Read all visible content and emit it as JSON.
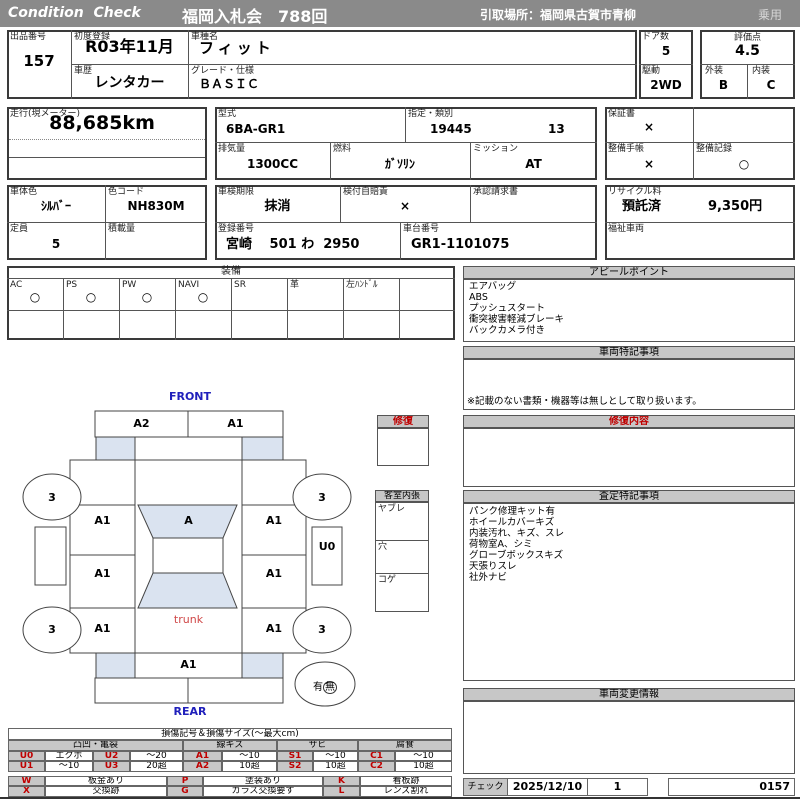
{
  "header": {
    "brand": "Condition  Check",
    "title": "福岡入札会　788回",
    "pickup": "引取場所：福岡県古賀市青柳",
    "usage": "乗用"
  },
  "info": {
    "lot_label": "出品番号",
    "lot": "157",
    "first_reg_label": "初度登録",
    "first_reg": "R03年11月",
    "model_label": "車種名",
    "model": "フィット",
    "history_label": "車歴",
    "history": "レンタカー",
    "grade_label": "グレード・仕様",
    "grade": "ＢＡＳＩＣ",
    "doors_label": "ドア数",
    "doors": "5",
    "drive_label": "駆動",
    "drive": "2WD",
    "score_label": "評価点",
    "score": "4.5",
    "ext_label": "外装",
    "ext": "B",
    "int_label": "内装",
    "int": "C",
    "mileage_label": "走行(現メーター)",
    "mileage": "88,685km",
    "type_label": "型式",
    "type": "6BA-GR1",
    "desig_label": "指定・類別",
    "desig1": "19445",
    "desig2": "13",
    "disp_label": "排気量",
    "disp": "1300CC",
    "fuel_label": "燃料",
    "fuel": "ｶﾞｿﾘﾝ",
    "trans_label": "ミッション",
    "trans": "AT",
    "warranty_label": "保証書",
    "warranty": "×",
    "maint_book_label": "整備手帳",
    "maint_book": "×",
    "maint_rec_label": "整備記録",
    "maint_rec": "○",
    "color_label": "車体色",
    "color": "ｼﾙﾊﾞｰ",
    "color_code_label": "色コード",
    "color_code": "NH830M",
    "capacity_label": "定員",
    "capacity": "5",
    "load_label": "積載量",
    "load": "",
    "inspection_label": "車検期限",
    "inspection": "抹消",
    "insurance_label": "検付自賠責",
    "insurance": "×",
    "approval_label": "承認請求書",
    "approval": "",
    "reg_no_label": "登録番号",
    "reg_no": "宮崎　 501 わ  2950",
    "chassis_label": "車台番号",
    "chassis": "GR1-1101075",
    "recycle_label": "リサイクル料",
    "recycle_status": "預託済",
    "recycle_fee": "9,350円",
    "welfare_label": "福祉車両",
    "welfare": ""
  },
  "equipment": {
    "title": "装備",
    "labels": [
      "AC",
      "PS",
      "PW",
      "NAVI",
      "SR",
      "革",
      "左ﾊﾝﾄﾞﾙ",
      ""
    ],
    "marks": [
      "○",
      "○",
      "○",
      "○",
      "",
      "",
      "",
      ""
    ]
  },
  "appeal": {
    "title": "アピールポイント",
    "lines": [
      "エアバッグ",
      "ABS",
      "プッシュスタート",
      "衝突被害軽減ブレーキ",
      "バックカメラ付き"
    ]
  },
  "vehicle_notes": {
    "title": "車両特記事項",
    "note": "※記載のない書類・機器等は無しとして取り扱います。"
  },
  "repair_section": {
    "title": "修復内容"
  },
  "repair_panel": {
    "title": "修復"
  },
  "cabin": {
    "title": "客室内張",
    "rows": [
      "ヤブレ",
      "穴",
      "コゲ"
    ]
  },
  "assessment": {
    "title": "査定特記事項",
    "lines": [
      "パンク修理キット有",
      "ホイールカバーキズ",
      "内装汚れ、キズ、スレ",
      "荷物室A、シミ",
      "グローブボックスキズ",
      "天張りスレ",
      "社外ナビ"
    ]
  },
  "change_info": {
    "title": "車両変更情報"
  },
  "check": {
    "label": "チェック",
    "date": "2025/12/10",
    "count": "1",
    "number": "0157"
  },
  "diagram": {
    "front": "FRONT",
    "rear": "REAR",
    "bumper_left": "A2",
    "bumper_right": "A1",
    "wheel": "3",
    "left_front_panel": "A1",
    "windshield": "A",
    "right_front_panel": "A1",
    "right_strip": "U0",
    "left_door": "A1",
    "right_door": "A1",
    "left_quarter": "A1",
    "trunk": "trunk",
    "right_quarter": "A1",
    "rear_panel": "A1",
    "spare_has": "有",
    "spare_none": "無"
  },
  "legend": {
    "title": "損傷記号＆損傷サイズ(〜最大cm)",
    "groups": [
      "凸凹・亀裂",
      "線キズ",
      "サビ",
      "腐食"
    ],
    "rows": [
      [
        "U0",
        "エクボ",
        "U2",
        "〜20",
        "A1",
        "〜10",
        "S1",
        "〜10",
        "C1",
        "〜10"
      ],
      [
        "U1",
        "〜10",
        "U3",
        "20超",
        "A2",
        "10超",
        "S2",
        "10超",
        "C2",
        "10超"
      ]
    ],
    "rows2": [
      [
        "W",
        "板金あり",
        "P",
        "塗装あり",
        "K",
        "看板跡"
      ],
      [
        "X",
        "交換跡",
        "G",
        "ガラス交換要す",
        "L",
        "レンズ割れ"
      ]
    ]
  }
}
